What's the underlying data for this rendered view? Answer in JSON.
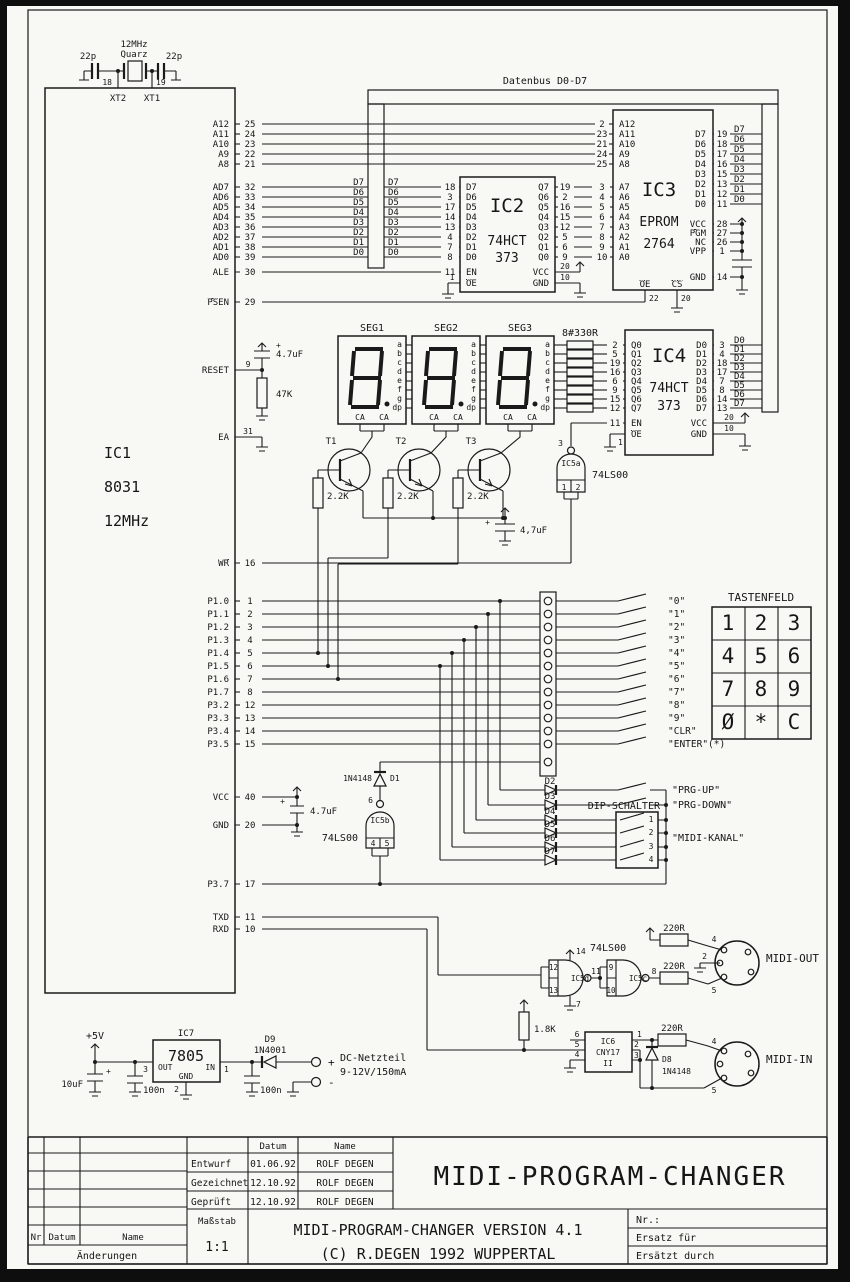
{
  "bus": {
    "label": "Datenbus D0-D7"
  },
  "marks": {
    "plus": "+"
  },
  "ic1": {
    "name": "IC1",
    "part": "8031",
    "clock": "12MHz",
    "xtal": {
      "freq": "12MHz",
      "type": "Quarz",
      "c1": "22p",
      "c2": "22p",
      "p18": "18",
      "p19": "19",
      "xt2": "XT2",
      "xt1": "XT1"
    },
    "addr": [
      [
        "A12",
        "25"
      ],
      [
        "A11",
        "24"
      ],
      [
        "A10",
        "23"
      ],
      [
        "A9",
        "22"
      ],
      [
        "A8",
        "21"
      ]
    ],
    "ad": [
      [
        "AD7",
        "32",
        "D7",
        "D7"
      ],
      [
        "AD6",
        "33",
        "D6",
        "D6"
      ],
      [
        "AD5",
        "34",
        "D5",
        "D5"
      ],
      [
        "AD4",
        "35",
        "D4",
        "D4"
      ],
      [
        "AD3",
        "36",
        "D3",
        "D3"
      ],
      [
        "AD2",
        "37",
        "D2",
        "D2"
      ],
      [
        "AD1",
        "38",
        "D1",
        "D1"
      ],
      [
        "AD0",
        "39",
        "D0",
        "D0"
      ]
    ],
    "ale": {
      "label": "ALE",
      "pin": "30"
    },
    "psen": {
      "label": "PSEN",
      "pin": "29"
    },
    "reset": {
      "label": "RESET",
      "pin": "9",
      "cap": "4.7uF",
      "res": "47K"
    },
    "ea": {
      "label": "EA",
      "pin": "31"
    },
    "wr": {
      "label": "WR",
      "pin": "16"
    },
    "ports": [
      [
        "P1.0",
        "1"
      ],
      [
        "P1.1",
        "2"
      ],
      [
        "P1.2",
        "3"
      ],
      [
        "P1.3",
        "4"
      ],
      [
        "P1.4",
        "5"
      ],
      [
        "P1.5",
        "6"
      ],
      [
        "P1.6",
        "7"
      ],
      [
        "P1.7",
        "8"
      ],
      [
        "P3.2",
        "12"
      ],
      [
        "P3.3",
        "13"
      ],
      [
        "P3.4",
        "14"
      ],
      [
        "P3.5",
        "15"
      ]
    ],
    "vcc": {
      "label": "VCC",
      "pin": "40",
      "cap": "4.7uF"
    },
    "gnd": {
      "label": "GND",
      "pin": "20"
    },
    "p37": {
      "label": "P3.7",
      "pin": "17"
    },
    "txd": {
      "label": "TXD",
      "pin": "11"
    },
    "rxd": {
      "label": "RXD",
      "pin": "10"
    }
  },
  "ic2": {
    "name": "IC2",
    "family": "74HCT",
    "part": "373",
    "left": [
      [
        "18",
        "D7"
      ],
      [
        "3",
        "D6"
      ],
      [
        "17",
        "D5"
      ],
      [
        "14",
        "D4"
      ],
      [
        "13",
        "D3"
      ],
      [
        "4",
        "D2"
      ],
      [
        "7",
        "D1"
      ],
      [
        "8",
        "D0"
      ]
    ],
    "right": [
      [
        "Q7",
        "19"
      ],
      [
        "Q6",
        "2"
      ],
      [
        "Q5",
        "16"
      ],
      [
        "Q4",
        "15"
      ],
      [
        "Q3",
        "12"
      ],
      [
        "Q2",
        "5"
      ],
      [
        "Q1",
        "6"
      ],
      [
        "Q0",
        "9"
      ]
    ],
    "en": {
      "label": "EN",
      "pin": "11"
    },
    "oe": {
      "label": "OE",
      "pin": "1"
    },
    "vcc": {
      "label": "VCC",
      "pin": "20"
    },
    "gnd": {
      "label": "GND",
      "pin": "10"
    }
  },
  "ic3": {
    "name": "IC3",
    "family": "EPROM",
    "part": "2764",
    "addr_upper": [
      [
        "2",
        "A12"
      ],
      [
        "23",
        "A11"
      ],
      [
        "21",
        "A10"
      ],
      [
        "24",
        "A9"
      ],
      [
        "25",
        "A8"
      ]
    ],
    "addr_lower": [
      [
        "3",
        "A7"
      ],
      [
        "4",
        "A6"
      ],
      [
        "5",
        "A5"
      ],
      [
        "6",
        "A4"
      ],
      [
        "7",
        "A3"
      ],
      [
        "8",
        "A2"
      ],
      [
        "9",
        "A1"
      ],
      [
        "10",
        "A0"
      ]
    ],
    "data": [
      [
        "D7",
        "19",
        "D7"
      ],
      [
        "D6",
        "18",
        "D6"
      ],
      [
        "D5",
        "17",
        "D5"
      ],
      [
        "D4",
        "16",
        "D4"
      ],
      [
        "D3",
        "15",
        "D3"
      ],
      [
        "D2",
        "13",
        "D2"
      ],
      [
        "D1",
        "12",
        "D1"
      ],
      [
        "D0",
        "11",
        "D0"
      ]
    ],
    "pwr": [
      [
        "VCC",
        "28"
      ],
      [
        "PGM",
        "27"
      ],
      [
        "NC",
        "26"
      ],
      [
        "VPP",
        "1"
      ]
    ],
    "gnd": {
      "label": "GND",
      "pin": "14"
    },
    "oe": {
      "label": "OE",
      "pin": "22"
    },
    "cs": {
      "label": "CS",
      "pin": "20"
    }
  },
  "ic4": {
    "name": "IC4",
    "family": "74HCT",
    "part": "373",
    "left": [
      [
        "2",
        "Q0"
      ],
      [
        "5",
        "Q1"
      ],
      [
        "19",
        "Q2"
      ],
      [
        "16",
        "Q3"
      ],
      [
        "6",
        "Q4"
      ],
      [
        "9",
        "Q5"
      ],
      [
        "15",
        "Q6"
      ],
      [
        "12",
        "Q7"
      ]
    ],
    "right": [
      [
        "D0",
        "3",
        "D0"
      ],
      [
        "D1",
        "4",
        "D1"
      ],
      [
        "D2",
        "18",
        "D2"
      ],
      [
        "D3",
        "17",
        "D3"
      ],
      [
        "D4",
        "7",
        "D4"
      ],
      [
        "D5",
        "8",
        "D5"
      ],
      [
        "D6",
        "14",
        "D6"
      ],
      [
        "D7",
        "13",
        "D7"
      ]
    ],
    "en": {
      "label": "EN",
      "pin": "11"
    },
    "oe": {
      "label": "OE",
      "pin": "1"
    },
    "vcc": {
      "label": "VCC",
      "pin": "20"
    },
    "gnd": {
      "label": "GND",
      "pin": "10"
    }
  },
  "display": {
    "titles": [
      "SEG1",
      "SEG2",
      "SEG3"
    ],
    "pins": [
      "a",
      "b",
      "c",
      "d",
      "e",
      "f",
      "g",
      "dp"
    ],
    "ca": "CA",
    "rnet": "8#330R"
  },
  "drivers": {
    "t": [
      "T1",
      "T2",
      "T3"
    ],
    "rb": "2.2K",
    "cap": "4,7uF"
  },
  "gates": {
    "ic5a": {
      "name": "IC5a",
      "out": "3",
      "in1": "1",
      "in2": "2",
      "family": "74LS00"
    },
    "ic5b": {
      "name": "IC5b",
      "out": "6",
      "in1": "4",
      "in2": "5",
      "family": "74LS00"
    },
    "ic5d": {
      "name": "IC5d",
      "in1": "12",
      "in2": "13",
      "out": "11",
      "vcc": "14",
      "gnd": "7"
    },
    "ic5c": {
      "name": "IC5c",
      "in1": "9",
      "in2": "10",
      "out": "8"
    },
    "family2": "74LS00"
  },
  "keys": {
    "labels": [
      "\"0\"",
      "\"1\"",
      "\"2\"",
      "\"3\"",
      "\"4\"",
      "\"5\"",
      "\"6\"",
      "\"7\"",
      "\"8\"",
      "\"9\"",
      "\"CLR\"",
      "\"ENTER\"(*)"
    ]
  },
  "keypad": {
    "title": "TASTENFELD",
    "rows": [
      [
        "1",
        "2",
        "3"
      ],
      [
        "4",
        "5",
        "6"
      ],
      [
        "7",
        "8",
        "9"
      ],
      [
        "Ø",
        "*",
        "C"
      ]
    ]
  },
  "aux": {
    "d1": {
      "part": "1N4148",
      "name": "D1"
    },
    "diodes": [
      "D2",
      "D3",
      "D4",
      "D5",
      "D6",
      "D7"
    ],
    "dip": {
      "title": "DIP-SCHALTER",
      "positions": [
        "1",
        "2",
        "3",
        "4"
      ]
    },
    "fn": {
      "prg_up": "\"PRG-UP\"",
      "prg_down": "\"PRG-DOWN\"",
      "midi_kanal": "\"MIDI-KANAL\""
    }
  },
  "midi": {
    "out": {
      "label": "MIDI-OUT",
      "r1": "220R",
      "r2": "220R",
      "pins": [
        "4",
        "2",
        "5"
      ]
    },
    "in": {
      "label": "MIDI-IN",
      "r": "220R",
      "pins": [
        "4",
        "5"
      ],
      "d8": {
        "name": "D8",
        "part": "1N4148"
      },
      "rpull": "1.8K"
    },
    "ic6": {
      "name": "IC6",
      "part": "CNY17",
      "suffix": "II",
      "lpins": [
        "6",
        "5",
        "4"
      ],
      "rpins": [
        "1",
        "2",
        "3"
      ]
    }
  },
  "power": {
    "v5": "+5V",
    "ic7": {
      "name": "IC7",
      "part": "7805",
      "out": "OUT",
      "in": "IN",
      "gnd": "GND",
      "pout": "3",
      "pgnd": "2",
      "pin": "1"
    },
    "d9": {
      "name": "D9",
      "part": "1N4001"
    },
    "c_bulk": "10uF",
    "c_out": "100n",
    "c_in": "100n",
    "plus": "+",
    "minus": "-",
    "supply1": "DC-Netzteil",
    "supply2": "9-12V/150mA"
  },
  "titleblock": {
    "datum_col": "Datum",
    "name_col": "Name",
    "rows": [
      [
        "Entwurf",
        "01.06.92",
        "ROLF DEGEN"
      ],
      [
        "Gezeichnet",
        "12.10.92",
        "ROLF DEGEN"
      ],
      [
        "Geprüft",
        "12.10.92",
        "ROLF DEGEN"
      ]
    ],
    "massstab": "Maßstab",
    "scale": "1:1",
    "nr": "Nr",
    "datum": "Datum",
    "name": "Name",
    "aenderungen": "Änderungen",
    "title": "MIDI-PROGRAM-CHANGER",
    "subtitle1": "MIDI-PROGRAM-CHANGER   VERSION 4.1",
    "subtitle2": "(C) R.DEGEN 1992  WUPPERTAL",
    "nr_label": "Nr.:",
    "ersatz": "Ersatz für",
    "ersetzt": "Ersätzt durch"
  }
}
